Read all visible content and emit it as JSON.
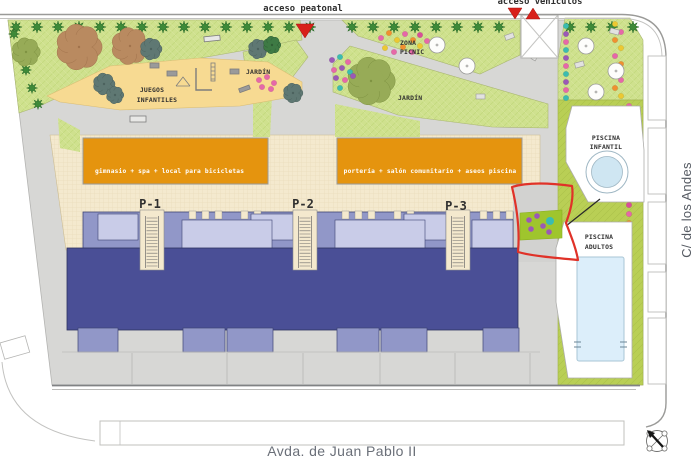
{
  "access": {
    "pedestrian": "acceso peatonal",
    "vehicle": "acceso vehículos"
  },
  "streets": {
    "bottom": "Avda. de Juan Pablo II",
    "right": "C/ de los Andes"
  },
  "areas": {
    "playground": {
      "line1": "JUEGOS",
      "line2": "INFANTILES"
    },
    "garden_small": "JARDÍN",
    "garden_large": "JARDÍN",
    "picnic": {
      "line1": "ZONA",
      "line2": "PICNIC"
    },
    "pool_infant": {
      "line1": "PISCINA",
      "line2": "INFANTIL"
    },
    "pool_adult": {
      "line1": "PISCINA",
      "line2": "ADULTOS"
    }
  },
  "buildings": {
    "services_west": "gimnasio + spa + local para bicicletas",
    "services_east": "portería + salón comunitario + aseos piscina",
    "portals": [
      "P-1",
      "P-2",
      "P-3"
    ]
  },
  "colors": {
    "park_green": "#cfe18e",
    "pool_green": "#b9cf55",
    "accent_green": "#9fc52d",
    "playground_sand": "#f7da92",
    "plaza_cream": "#f4e9ce",
    "building_navy": "#4a4f96",
    "building_blue": "#9197c8",
    "building_lavender": "#c9cce8",
    "services_orange": "#e5940e",
    "pool_water": "#d6eaf6",
    "paving_gray": "#d7d7d5",
    "annotation_red": "#e03228",
    "marker_red": "#d8201a"
  }
}
